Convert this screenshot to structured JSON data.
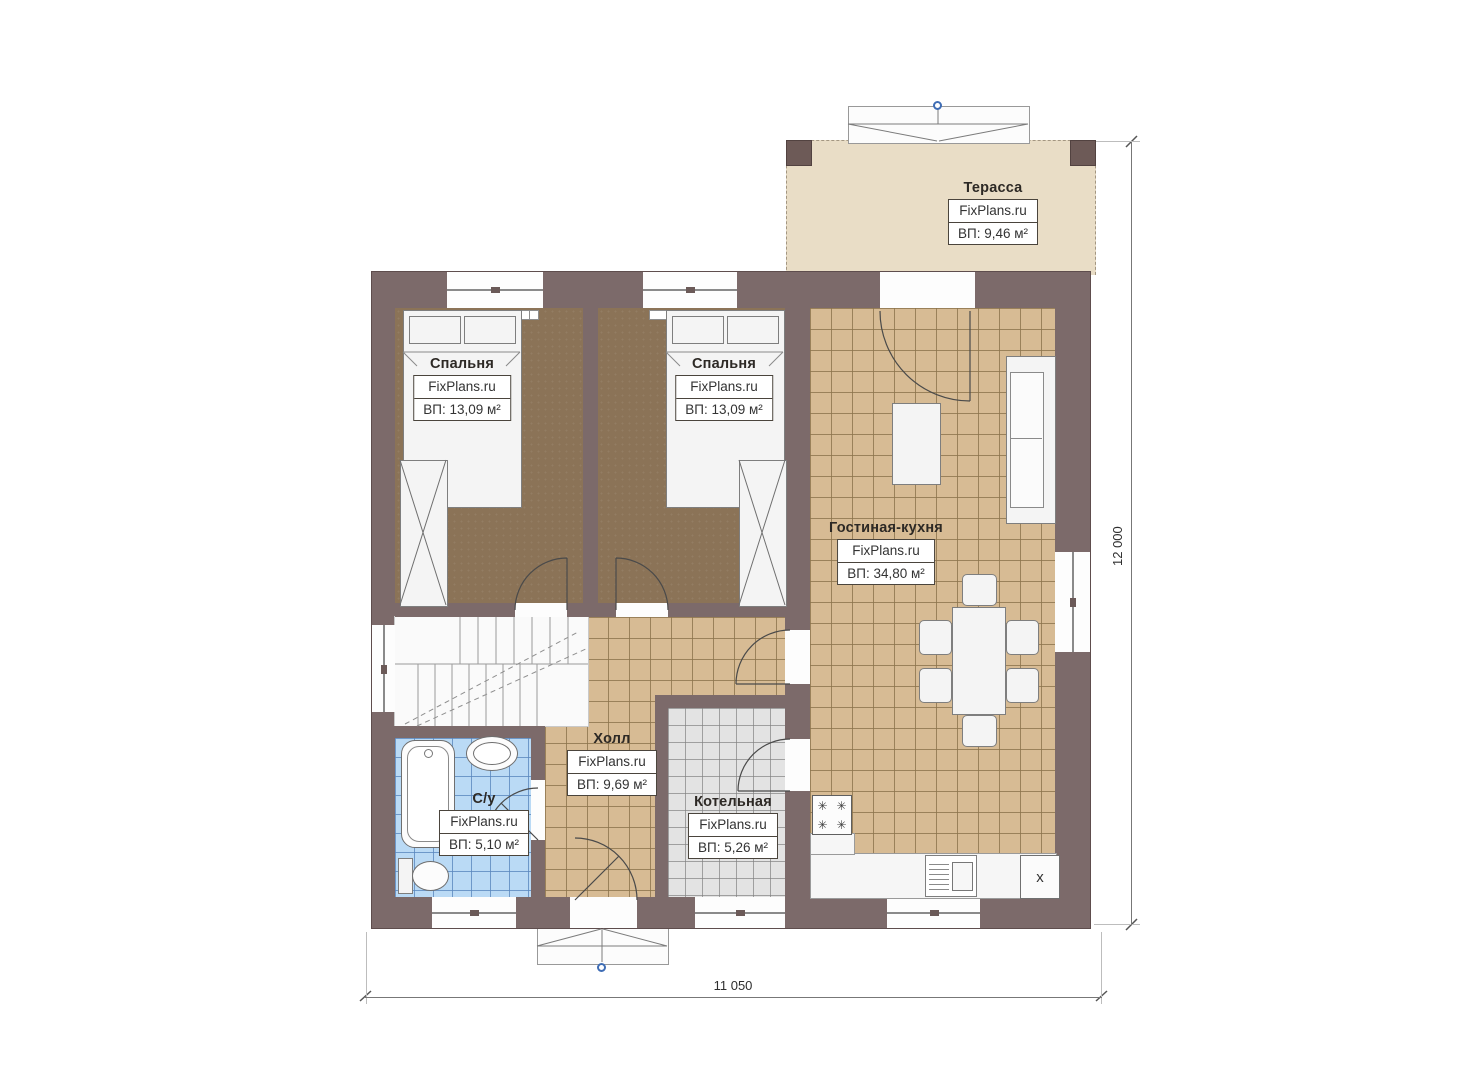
{
  "rooms": {
    "terrace": {
      "name": "Терасса",
      "brand": "FixPlans.ru",
      "area": "ВП: 9,46 м²"
    },
    "bedroom1": {
      "name": "Спальня",
      "brand": "FixPlans.ru",
      "area": "ВП: 13,09 м²"
    },
    "bedroom2": {
      "name": "Спальня",
      "brand": "FixPlans.ru",
      "area": "ВП: 13,09 м²"
    },
    "living": {
      "name": "Гостиная-кухня",
      "brand": "FixPlans.ru",
      "area": "ВП: 34,80 м²"
    },
    "hall": {
      "name": "Холл",
      "brand": "FixPlans.ru",
      "area": "ВП: 9,69 м²"
    },
    "bathroom": {
      "name": "С/у",
      "brand": "FixPlans.ru",
      "area": "ВП: 5,10 м²"
    },
    "boiler": {
      "name": "Котельная",
      "brand": "FixPlans.ru",
      "area": "ВП: 5,26 м²"
    }
  },
  "dimensions": {
    "width_label": "11 050",
    "height_label": "12 000"
  },
  "appliances": {
    "fridge_label": "x",
    "burner_glyph": "✳"
  },
  "colors": {
    "wall": "#7c6a6a",
    "terrace_floor": "#e9ddc6",
    "carpet": "#8b7357",
    "tile_tan": "#d7bb94",
    "tile_blue": "#badaf5",
    "tile_gray": "#e3e3e3",
    "marker_blue": "#3f6db5"
  }
}
